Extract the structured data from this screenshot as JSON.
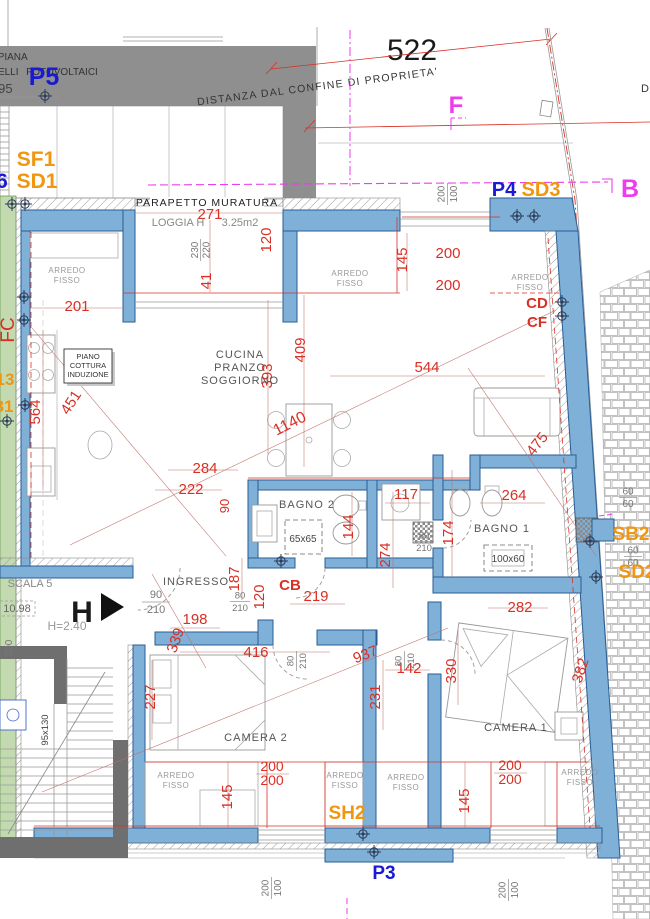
{
  "distance": {
    "value": "522",
    "label": "DISTANZA DAL CONFINE DI PROPRIETA'",
    "d_partial": "D"
  },
  "roof": {
    "piana": "URA PIANA",
    "pannelli": "NNELLI",
    "fotovoltaici": "FOTOVOLTAICI",
    "quota": "0.95"
  },
  "markers": {
    "p5": "P5",
    "p4": "P4",
    "p3": "P3",
    "f": "F",
    "b": "B",
    "six": "6",
    "sf1": "SF1",
    "sd1": "SD1",
    "sd3": "SD3",
    "sb2": "SB2",
    "sd2": "SD2",
    "sh2": "SH2",
    "cd": "CD",
    "cf": "CF",
    "cb": "CB",
    "fc": "FC"
  },
  "rooms": {
    "cucina1": "CUCINA",
    "cucina2": "PRANZO",
    "cucina3": "SOGGIORNO",
    "bagno2": "BAGNO  2",
    "bagno1": "BAGNO  1",
    "ingresso": "INGRESSO",
    "camera2": "CAMERA  2",
    "camera1": "CAMERA  1",
    "loggia": "LOGGIA  H",
    "loggia_area": "3.25m2",
    "parapetto": "PARAPETTO  MURATURA",
    "arredo1": "ARREDO",
    "arredo2": "FISSO",
    "piano1": "PIANO",
    "piano2": "COTTURA",
    "piano3": "INDUZIONE",
    "scala": "SCALA  5",
    "quota": "10.98",
    "altezza": "H=2.40",
    "section": "H"
  },
  "fixtures": {
    "shower": "65x65",
    "table": "100x60",
    "window": "95x130"
  },
  "dims_red": {
    "d271": "271",
    "d201": "201",
    "d41": "41",
    "d120": "120",
    "d145": "145",
    "d200": "200",
    "d544": "544",
    "d409": "409",
    "d393": "393",
    "d564": "564",
    "d451": "451",
    "d1140": "1140",
    "d284": "284",
    "d222": "222",
    "d90": "90",
    "d117": "117",
    "d264": "264",
    "d144": "144",
    "d274": "274",
    "d174": "174",
    "d187": "187",
    "d219": "219",
    "d198": "198",
    "d339": "339",
    "d416": "416",
    "d227": "227",
    "d937": "937",
    "d142": "142",
    "d231": "231",
    "d282": "282",
    "d330": "330",
    "d382": "382",
    "d475": "475"
  },
  "dims_gray": {
    "n200": "200",
    "n100": "100",
    "n80": "80",
    "n210": "210",
    "n90": "90",
    "n60": "60",
    "n230": "230",
    "n220": "220"
  },
  "fragments": {
    "f13": "13",
    "f81": "81"
  },
  "colors": {
    "wall": "#7fb0d8",
    "wall_stroke": "#2a5d94",
    "green": "#c3dab1",
    "roof": "#8f8f8f",
    "stair": "#6f6f6f",
    "dim_red": "#d93025",
    "magenta": "#ee3bee",
    "orange": "#f0960f",
    "label_blue": "#1a1ad4"
  }
}
